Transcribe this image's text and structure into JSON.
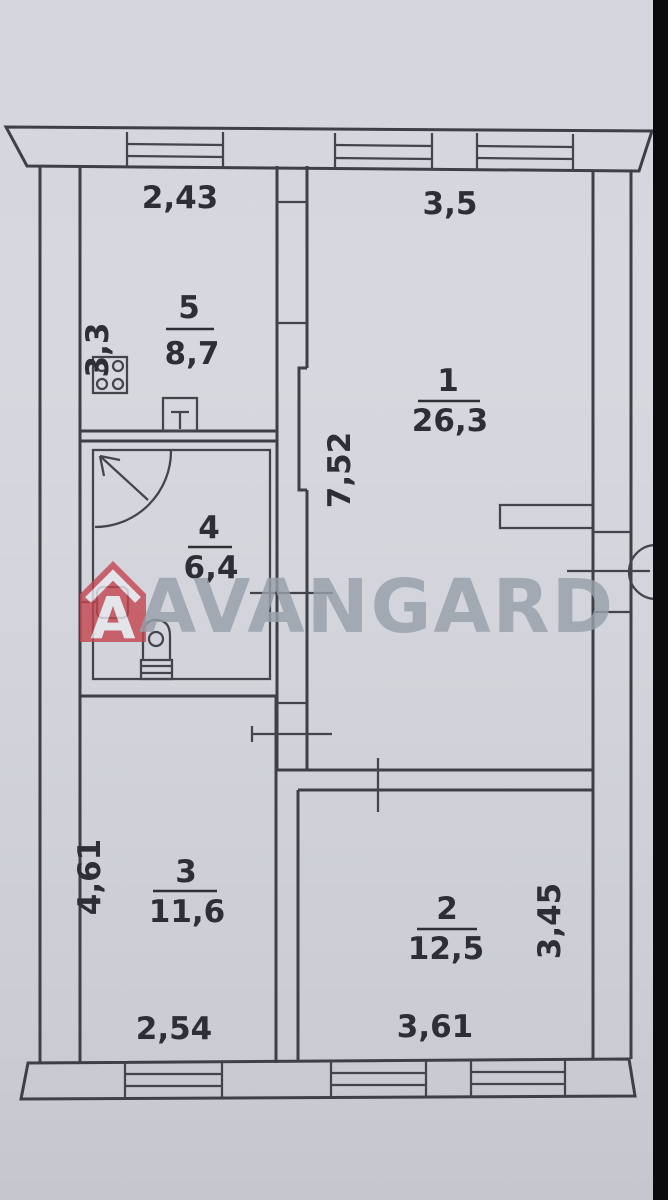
{
  "watermark": {
    "brand": "AVANGARD",
    "logo_letter": "A",
    "logo_color": "#c4454f",
    "text_color": "#99a0ab"
  },
  "plan": {
    "paper_color": "#d4d5dc",
    "line_color": "#3f3f46",
    "rooms": [
      {
        "number": "1",
        "area": "26,3"
      },
      {
        "number": "2",
        "area": "12,5"
      },
      {
        "number": "3",
        "area": "11,6"
      },
      {
        "number": "4",
        "area": "6,4"
      },
      {
        "number": "5",
        "area": "8,7"
      }
    ],
    "dims": {
      "kitchen_width": "2,43",
      "living_width": "3,5",
      "kitchen_height": "3,3",
      "living_height": "7,52",
      "room3_height": "4,61",
      "room2_height": "3,45",
      "room3_bottom_width": "2,54",
      "room2_bottom_width": "3,61"
    }
  }
}
